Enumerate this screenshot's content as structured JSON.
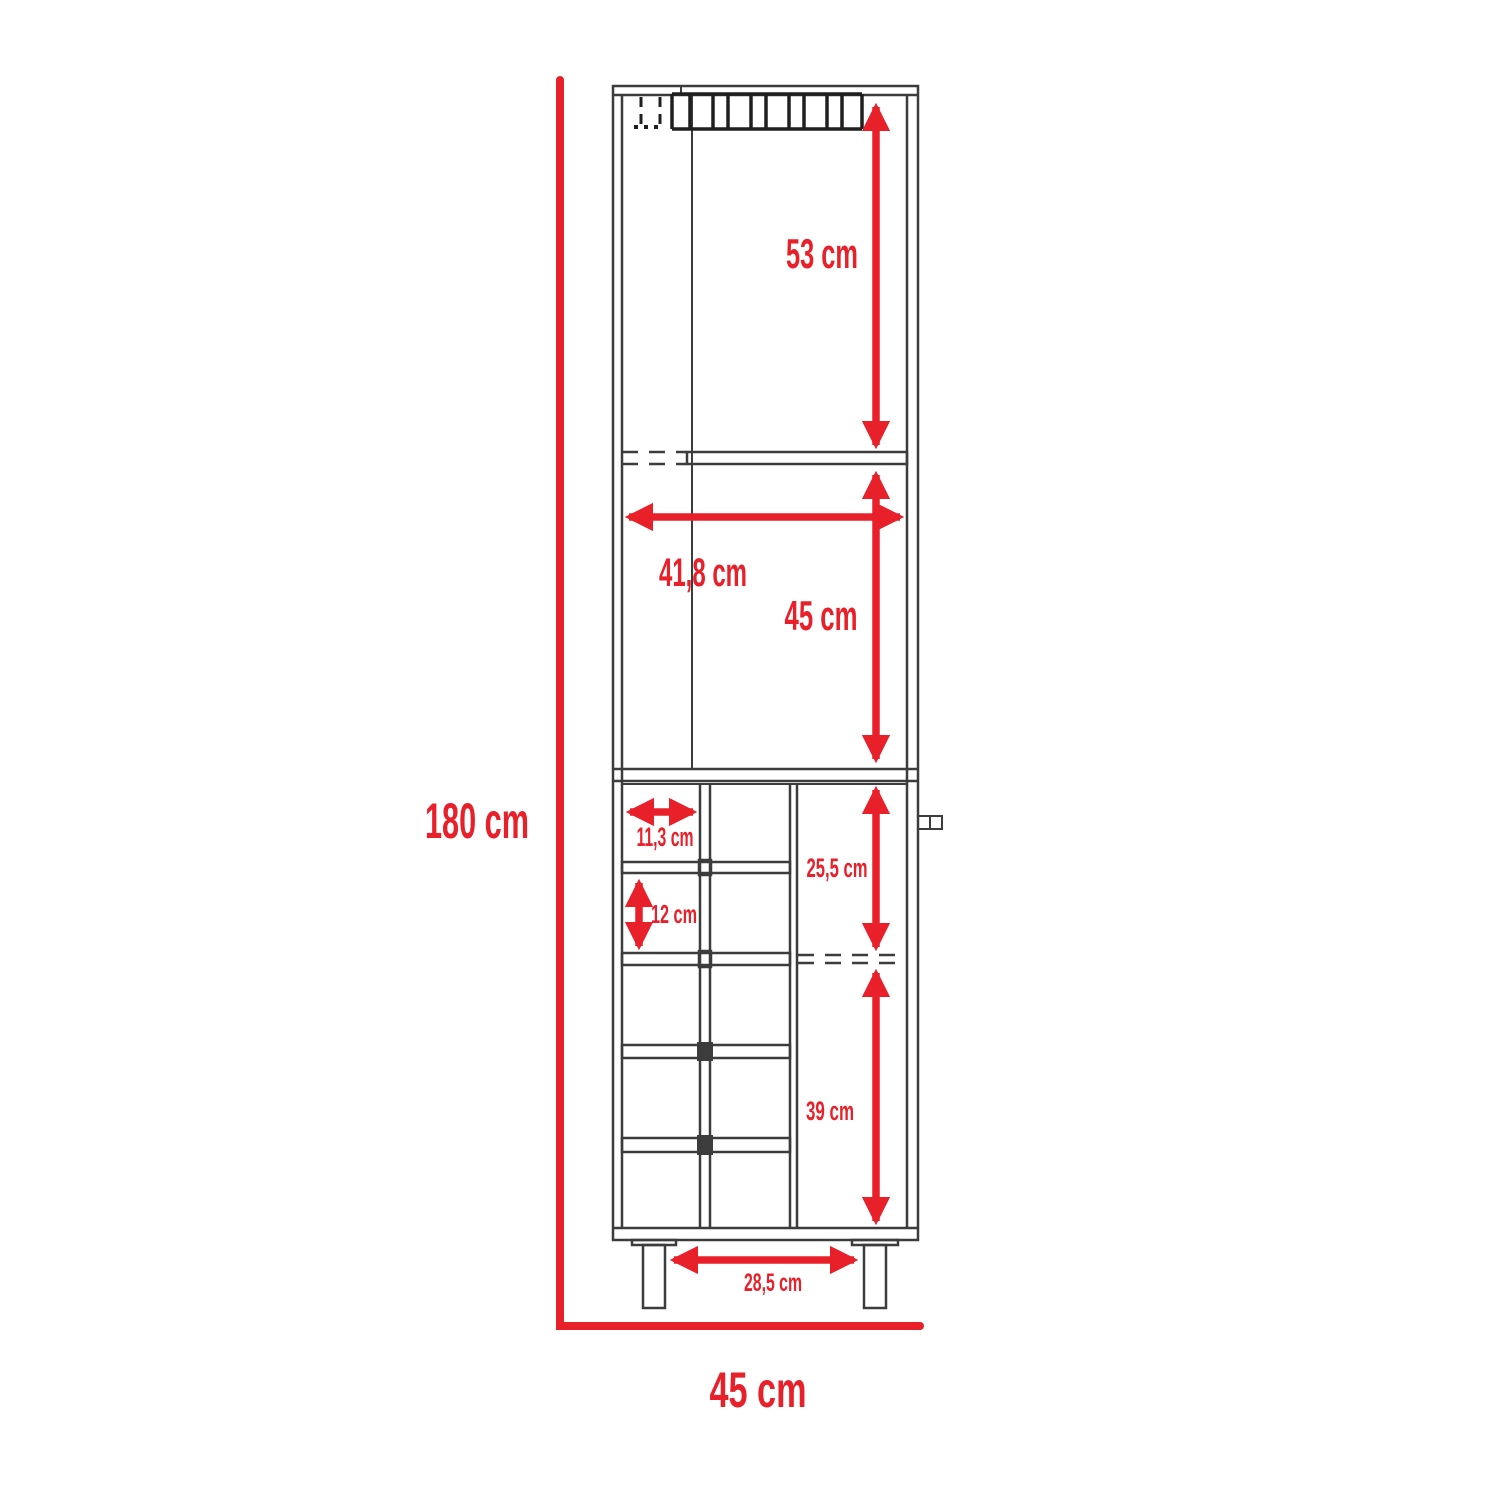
{
  "diagram": {
    "type": "furniture-dimension-drawing",
    "subject": "tall bar cabinet with stemware rack and bottle cubbies, front elevation",
    "colors": {
      "dimension": "#e8202a",
      "outline": "#3c3c3c",
      "background": "#ffffff"
    },
    "labels": {
      "overall_height": "180 cm",
      "overall_width": "45 cm",
      "top_section_height": "53 cm",
      "interior_width": "41,8 cm",
      "middle_section_height": "45 cm",
      "cubby_width": "11,3 cm",
      "cubby_height": "12 cm",
      "door_upper_height": "25,5 cm",
      "door_lower_height": "39 cm",
      "leg_spacing": "28,5 cm"
    }
  }
}
